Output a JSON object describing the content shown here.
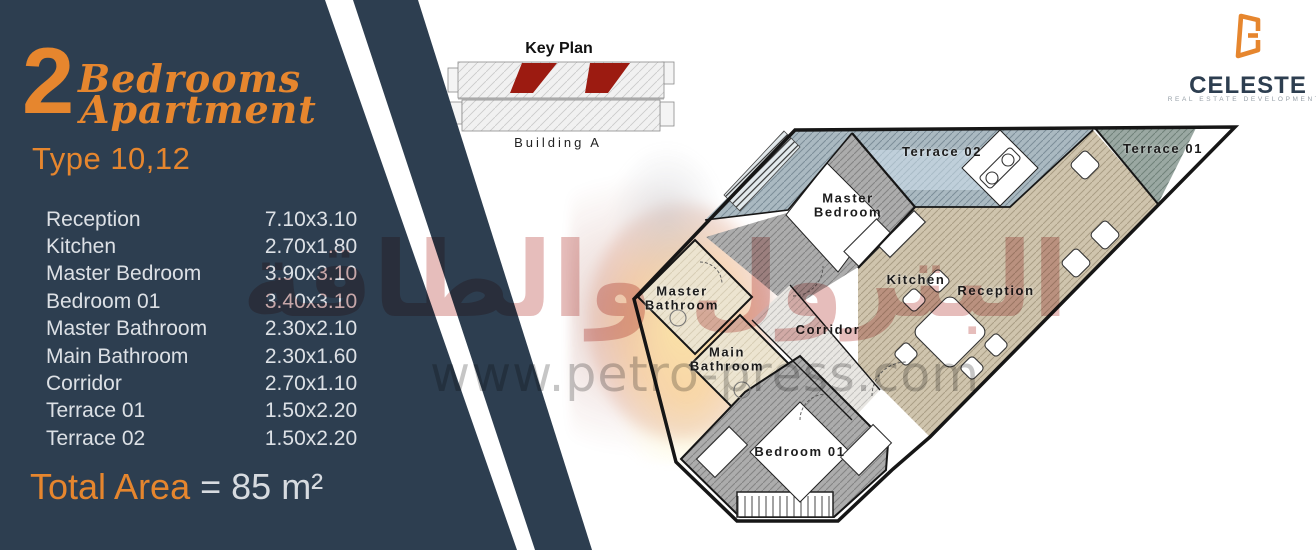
{
  "panel": {
    "number": "2",
    "title_line1": "Bedrooms",
    "title_line2": "Apartment",
    "type_label": "Type 10,12",
    "rooms": [
      {
        "name": "Reception",
        "dim": "7.10x3.10"
      },
      {
        "name": "Kitchen",
        "dim": "2.70x1.80"
      },
      {
        "name": "Master Bedroom",
        "dim": "3.90x3.10"
      },
      {
        "name": "Bedroom 01",
        "dim": "3.40x3.10"
      },
      {
        "name": "Master Bathroom",
        "dim": "2.30x2.10"
      },
      {
        "name": "Main Bathroom",
        "dim": "2.30x1.60"
      },
      {
        "name": "Corridor",
        "dim": "2.70x1.10"
      },
      {
        "name": "Terrace 01",
        "dim": "1.50x2.20"
      },
      {
        "name": "Terrace 02",
        "dim": "1.50x2.20"
      }
    ],
    "total_label": "Total Area",
    "total_value": "= 85 m²"
  },
  "key_plan": {
    "title": "Key Plan",
    "building_label": "Building A"
  },
  "logo": {
    "brand": "CELESTE",
    "tagline": "REAL ESTATE DEVELOPMENTS"
  },
  "floor_plan": {
    "labels": {
      "terrace02": "Terrace 02",
      "terrace01": "Terrace 01",
      "master_bedroom": "Master Bedroom",
      "kitchen": "Kitchen",
      "reception": "Reception",
      "master_bathroom": "Master Bathroom",
      "corridor": "Corridor",
      "main_bathroom": "Main Bathroom",
      "bedroom01": "Bedroom 01"
    }
  },
  "watermark": {
    "arabic_text": "البترول والطاقة",
    "url_text": "www.petro-press.com"
  },
  "colors": {
    "navy": "#2D3E50",
    "orange": "#E6862E",
    "table_text": "#DCE0E5",
    "keyplan_unit_red": "#9C1B11",
    "terrace02_fill": "#AAB9C1",
    "terrace01_fill": "#9AA8A2",
    "bedroom_fill": "#ACACAC",
    "reception_fill": "#CFC4AD",
    "bathroom_fill": "#ECE4D0"
  }
}
